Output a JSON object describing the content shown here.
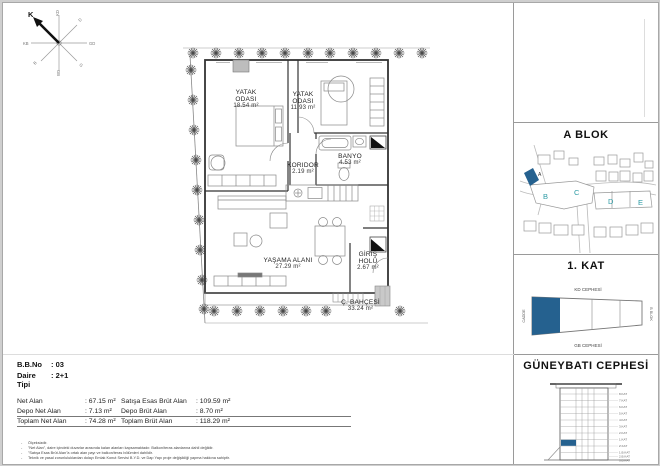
{
  "compass": {
    "n": "K",
    "ne": "KD",
    "e": "D",
    "se": "GD",
    "s": "G",
    "sw": "GB",
    "w": "B",
    "nw": "KB"
  },
  "plan": {
    "rooms": {
      "yatak1": {
        "l1": "YATAK",
        "l2": "ODASI",
        "area": "18.54 m²"
      },
      "yatak2": {
        "l1": "YATAK",
        "l2": "ODASI",
        "area": "11.93 m²"
      },
      "koridor": {
        "l1": "KORIDOR",
        "area": "2.19 m²"
      },
      "banyo": {
        "l1": "BANYO",
        "area": "4.53 m²"
      },
      "yasama": {
        "l1": "YAŞAMA ALANI",
        "area": "27.29 m²"
      },
      "giris": {
        "l1": "GİRİŞ",
        "l2": "HOLÜ",
        "area": "2.67 m²"
      },
      "bahce": {
        "l1": "Ç. BAHÇESİ",
        "area": "33.24 m²"
      }
    }
  },
  "sidebar": {
    "block_panel": {
      "title": "A BLOK",
      "labels": {
        "a": "A",
        "b": "B",
        "c": "C",
        "d": "D",
        "e": "E"
      }
    },
    "floor_panel": {
      "title": "1. KAT",
      "top": "KD CEPHESİ",
      "bottom": "GB CEPHESİ",
      "left": "CADDE",
      "right": "B BLOK"
    },
    "facade_panel": {
      "title": "GÜNEYBATI CEPHESİ",
      "floors": [
        "8.KAT",
        "7.KAT",
        "6.KAT",
        "5.KAT",
        "4.KAT",
        "3.KAT",
        "2.KAT",
        "1.KAT",
        "Z.KAT",
        "1.B.KAT",
        "2.B.KAT",
        "3.B.KAT"
      ]
    }
  },
  "info": {
    "bb_no_label": "B.B.No",
    "bb_no_value": ": 03",
    "tip_label": "Daire Tipi",
    "tip_value": ": 2+1",
    "rows": [
      {
        "l_label": "Net Alan",
        "l_value": ": 67.15 m²",
        "r_label": "Satışa Esas Brüt Alan",
        "r_value": ": 109.59 m²"
      },
      {
        "l_label": "Depo Net Alan",
        "l_value": ": 7.13 m²",
        "r_label": "Depo Brüt Alan",
        "r_value": ": 8.70 m²"
      },
      {
        "l_label": "Toplam Net Alan",
        "l_value": ": 74.28 m²",
        "r_label": "Toplam Brüt Alan",
        "r_value": ": 118.29 m²"
      }
    ]
  },
  "footnotes": [
    "Ölçeksizdir.",
    "\"Net Alan\", daire içindeki duvarlar arasında kalan alanları kapsamaktadır. Balkon/teras alanlarına dahil değildir.",
    "\"Satışa Esas Brüt Alan\"a ortak alan payı ve balkon/teras bölümleri dahildir.",
    "Teknik ve yasal zorunluluklardan dolayı Emlak Konut Servisi B.Y.D. ve Dap Yapı proje değişikliği yapma hakkına sahiptir."
  ],
  "colors": {
    "accent": "#25618f",
    "teal": "#2e9ba5"
  }
}
